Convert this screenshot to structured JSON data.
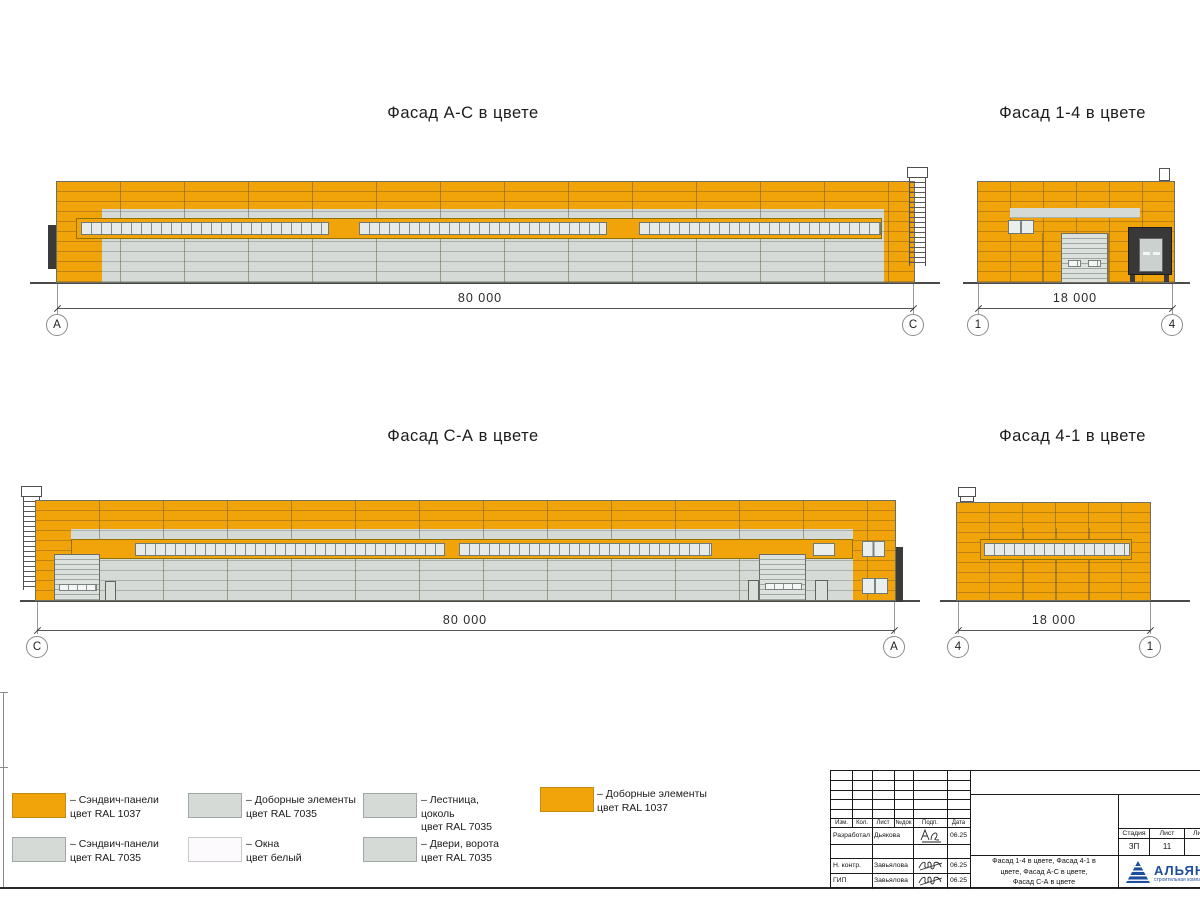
{
  "colors": {
    "sandwich_orange_ral1037": "#F1A30A",
    "sandwich_gray_ral7035": "#D5DAD6",
    "window_white": "#FCFAFC",
    "dock_shelter_dark": "#3A3A3A",
    "logo_blue": "#1D4E9E"
  },
  "facades": {
    "ac": {
      "title": "Фасад А-С в цвете",
      "dim": "80 000",
      "marker_left": "А",
      "marker_right": "С"
    },
    "f14": {
      "title": "Фасад 1-4 в цвете",
      "dim": "18 000",
      "marker_left": "1",
      "marker_right": "4"
    },
    "ca": {
      "title": "Фасад С-А в цвете",
      "dim": "80 000",
      "marker_left": "С",
      "marker_right": "А"
    },
    "f41": {
      "title": "Фасад 4-1 в цвете",
      "dim": "18 000",
      "marker_left": "4",
      "marker_right": "1"
    }
  },
  "legend": {
    "items": [
      {
        "color": "#F1A30A",
        "label": "– Сэндвич-панели\nцвет RAL 1037"
      },
      {
        "color": "#D5DAD6",
        "label": "– Сэндвич-панели\nцвет RAL 7035"
      },
      {
        "color": "#D5DAD6",
        "label": "– Доборные элементы\nцвет RAL 7035"
      },
      {
        "color": "#FCFAFC",
        "label": "– Окна\nцвет белый"
      },
      {
        "color": "#D5DAD6",
        "label": "– Лестница,\nцоколь\nцвет RAL 7035"
      },
      {
        "color": "#D5DAD6",
        "label": "– Двери, ворота\nцвет RAL 7035"
      },
      {
        "color": "#F1A30A",
        "label": "– Доборные элементы\nцвет RAL 1037"
      }
    ]
  },
  "titleblock": {
    "headers": {
      "izm": "Изм.",
      "kol": "Кол.",
      "list": "Лист",
      "ndok": "№док",
      "podp": "Подп.",
      "data": "Дата"
    },
    "rows": [
      {
        "role": "Разработал",
        "name": "Дьякова",
        "date": "06.25"
      },
      {
        "role": "Н. контр.",
        "name": "Завьялова",
        "date": "06.25"
      },
      {
        "role": "ГИП",
        "name": "Завьялова",
        "date": "06.25"
      }
    ],
    "doc_title": "Фасад 1-4 в цвете, Фасад 4-1 в\nцвете, Фасад А-С в цвете,\nФасад С-А в цвете",
    "stage_header": "Стадия",
    "sheet_header": "Лист",
    "sheets_header": "Листов",
    "stage": "ЗП",
    "sheet": "11",
    "sheets": "1",
    "logo_text": "АЛЬЯНС",
    "logo_sub": "строительная компания"
  }
}
